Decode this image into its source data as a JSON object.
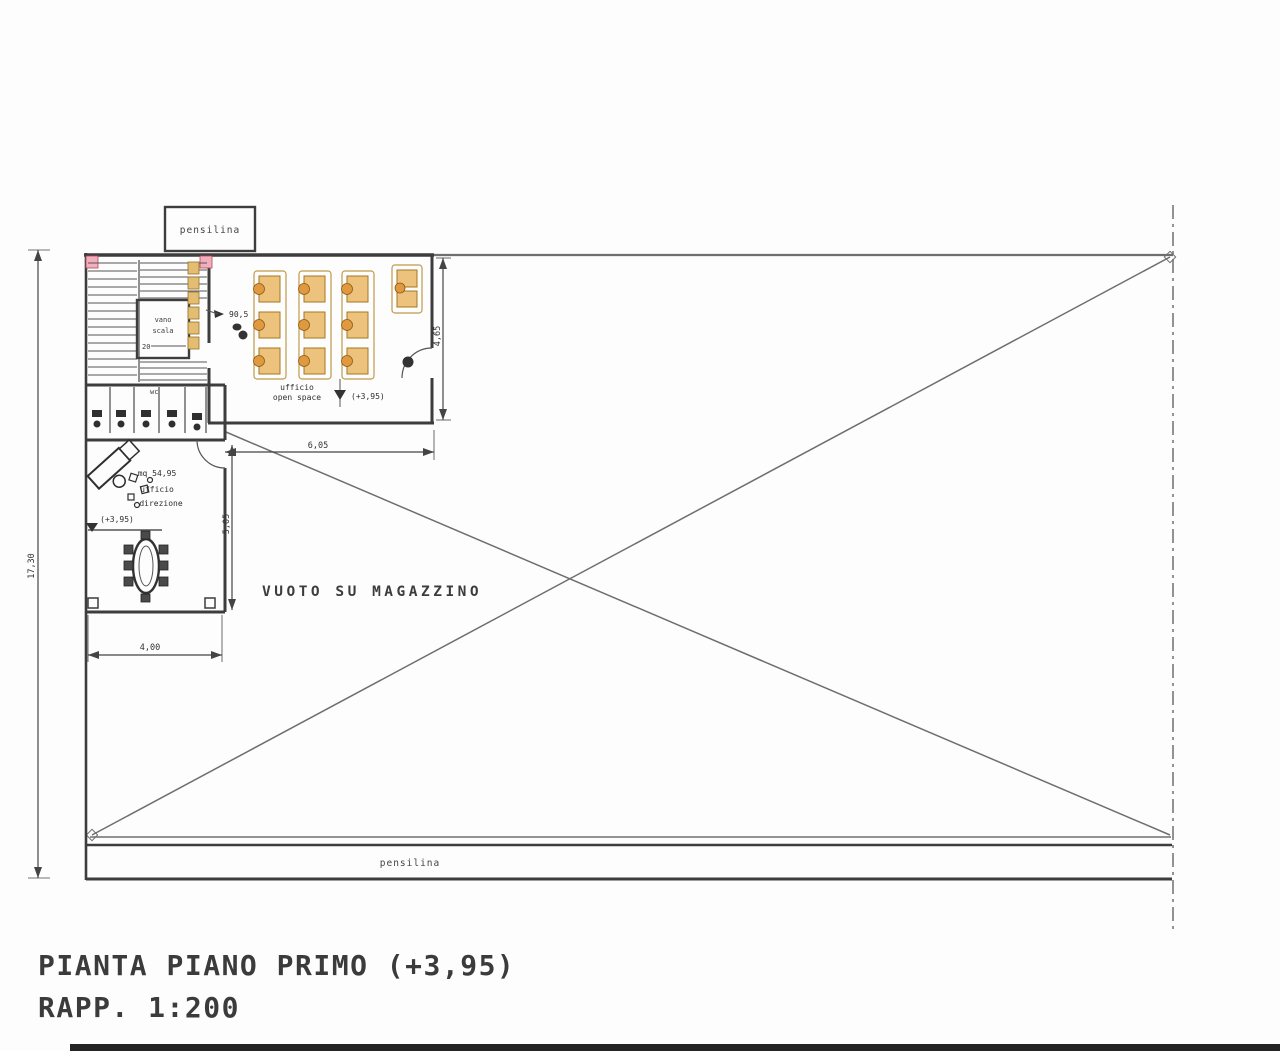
{
  "title": {
    "line1": "PIANTA PIANO PRIMO (+3,95)",
    "line2": "RAPP. 1:200"
  },
  "labels": {
    "canopy_top": "pensilina",
    "canopy_bottom": "pensilina",
    "void_area": "VUOTO SU MAGAZZINO",
    "stairwell_line1": "vano",
    "stairwell_line2": "scala",
    "stairwell_steps": "20",
    "wc": "wc",
    "open_office": {
      "area": "90,5",
      "name_line1": "ufficio",
      "name_line2": "open space",
      "level": "(+3,95)"
    },
    "director_office": {
      "area": "mq 54,95",
      "name_line1": "ufficio",
      "name_line2": "direzione",
      "level": "(+3,95)"
    }
  },
  "dimensions": {
    "director_office_width": "4,00",
    "void_width": "6,05",
    "open_office_depth": "4,65",
    "director_office_depth": "5,05",
    "building_depth": "17,30"
  },
  "colors": {
    "wall": "#3d3d3d",
    "frame_line": "#6e6e6e",
    "desk_fill": "#ecc27c",
    "chair_fill": "#e0993f",
    "accent_pink": "#f2aebc",
    "paper": "#fdfdfd"
  }
}
